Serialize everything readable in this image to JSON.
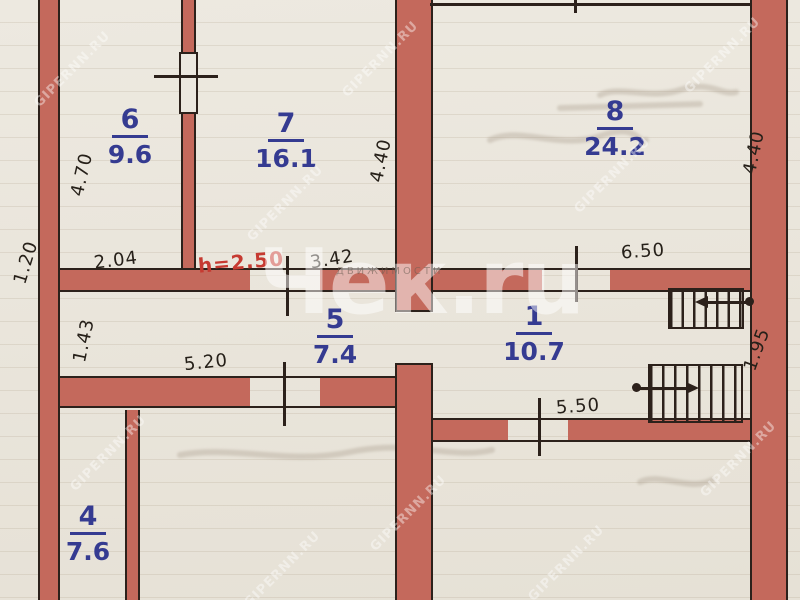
{
  "plan": {
    "rooms": [
      {
        "number": "6",
        "area": "9.6"
      },
      {
        "number": "7",
        "area": "16.1"
      },
      {
        "number": "8",
        "area": "24.2"
      },
      {
        "number": "5",
        "area": "7.4"
      },
      {
        "number": "1",
        "area": "10.7"
      },
      {
        "number": "4",
        "area": "7.6"
      }
    ],
    "dimensions": {
      "outer_left": "1.20",
      "room6_depth": "4.70",
      "room6_width": "2.04",
      "room7_width": "3.42",
      "room7_depth": "4.40",
      "room8_depth": "4.40",
      "room8_width": "6.50",
      "corridor_depth": "1.43",
      "corridor_width": "5.20",
      "room1_width": "5.50",
      "stair_depth": "1.95"
    },
    "ceiling_height_note": "h=2.50",
    "colors": {
      "wall_fill": "#c4695c",
      "outline_ink": "#2c211b",
      "room_ink_blue": "#353b91",
      "dimension_ink": "#262019",
      "height_note_red": "#c63a31",
      "paper": "#ece8df"
    }
  },
  "watermarks": {
    "site": "GIPERNN.RU",
    "center_logo": "Чек.ru",
    "strip": "ДВИЖИМОСТИ"
  }
}
